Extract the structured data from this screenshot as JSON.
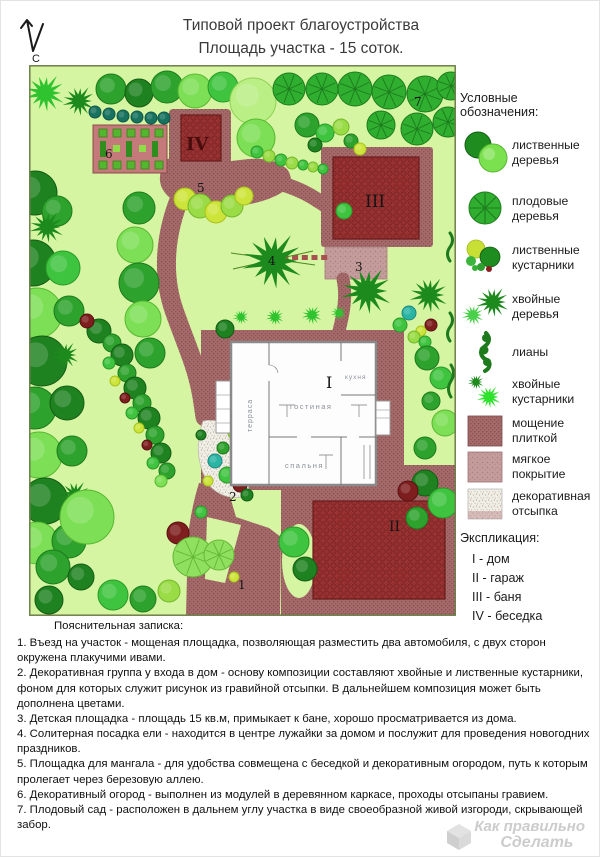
{
  "title": {
    "line1": "Типовой проект благоустройства",
    "line2": "Площадь участка - 15 соток."
  },
  "compass_label": "С",
  "plan": {
    "labels": {
      "house": "I",
      "garage": "II",
      "bath": "III",
      "gazebo": "IV",
      "entrance": "1",
      "decor_group": "2",
      "playground": "3",
      "spruce": "4",
      "bbq": "5",
      "garden": "6",
      "orchard": "7"
    },
    "rooms": {
      "terrace": "терраса",
      "living": "гостиная",
      "kitchen": "кухня",
      "bedroom": "спальня"
    }
  },
  "legend": {
    "title": "Условные обозначения:",
    "items": [
      {
        "icon": "deciduous-trees",
        "label": "лиственные деревья"
      },
      {
        "icon": "fruit-trees",
        "label": "плодовые деревья"
      },
      {
        "icon": "deciduous-shrubs",
        "label": "лиственные кустарники"
      },
      {
        "icon": "conifer-trees",
        "label": "хвойные деревья"
      },
      {
        "icon": "lianas",
        "label": "лианы"
      },
      {
        "icon": "conifer-shrubs",
        "label": "хвойные кустарники"
      },
      {
        "icon": "tile-paving",
        "label": "мощение плиткой"
      },
      {
        "icon": "soft-surface",
        "label": "мягкое покрытие"
      },
      {
        "icon": "decorative-gravel",
        "label": "декоративная отсыпка"
      }
    ]
  },
  "explication": {
    "title": "Экспликация:",
    "items": [
      "I - дом",
      "II - гараж",
      "III - баня",
      "IV - беседка"
    ]
  },
  "notes": {
    "title": "Пояснительная записка:",
    "items": [
      "1. Въезд на участок - мощеная площадка, позволяющая разместить два автомобиля, с двух сторон окружена плакучими ивами.",
      "2. Декоративная группа у входа в дом - основу композиции составляют хвойные и лиственные кустарники, фоном для которых служит рисунок из гравийной отсыпки. В дальнейшем композиция может быть дополнена цветами.",
      "3. Детская площадка - площадь 15 кв.м, примыкает к бане, хорошо просматривается из дома.",
      "4. Солитерная посадка ели - находится в центре лужайки за домом и послужит для проведения новогодних праздников.",
      "5. Площадка для мангала - для удобства совмещена с беседкой и декоративным огородом, путь к которым пролегает через березовую аллею.",
      "6. Декоративный огород - выполнен из модулей в деревянном каркасе, проходы отсыпаны гравием.",
      "7. Плодовый сад - расположен в дальнем углу участка в виде своеобразной живой изгороди, скрывающей забор."
    ]
  },
  "watermark": {
    "line1": "Как правильно",
    "line2": "Сделать"
  },
  "colors": {
    "lawn": "#d6f5a2",
    "paving": "#a76a6a",
    "building": "#9c3333",
    "tree_dark": "#1f8220",
    "tree_light": "#7ddf55",
    "accent_red": "#7e1e1e"
  }
}
